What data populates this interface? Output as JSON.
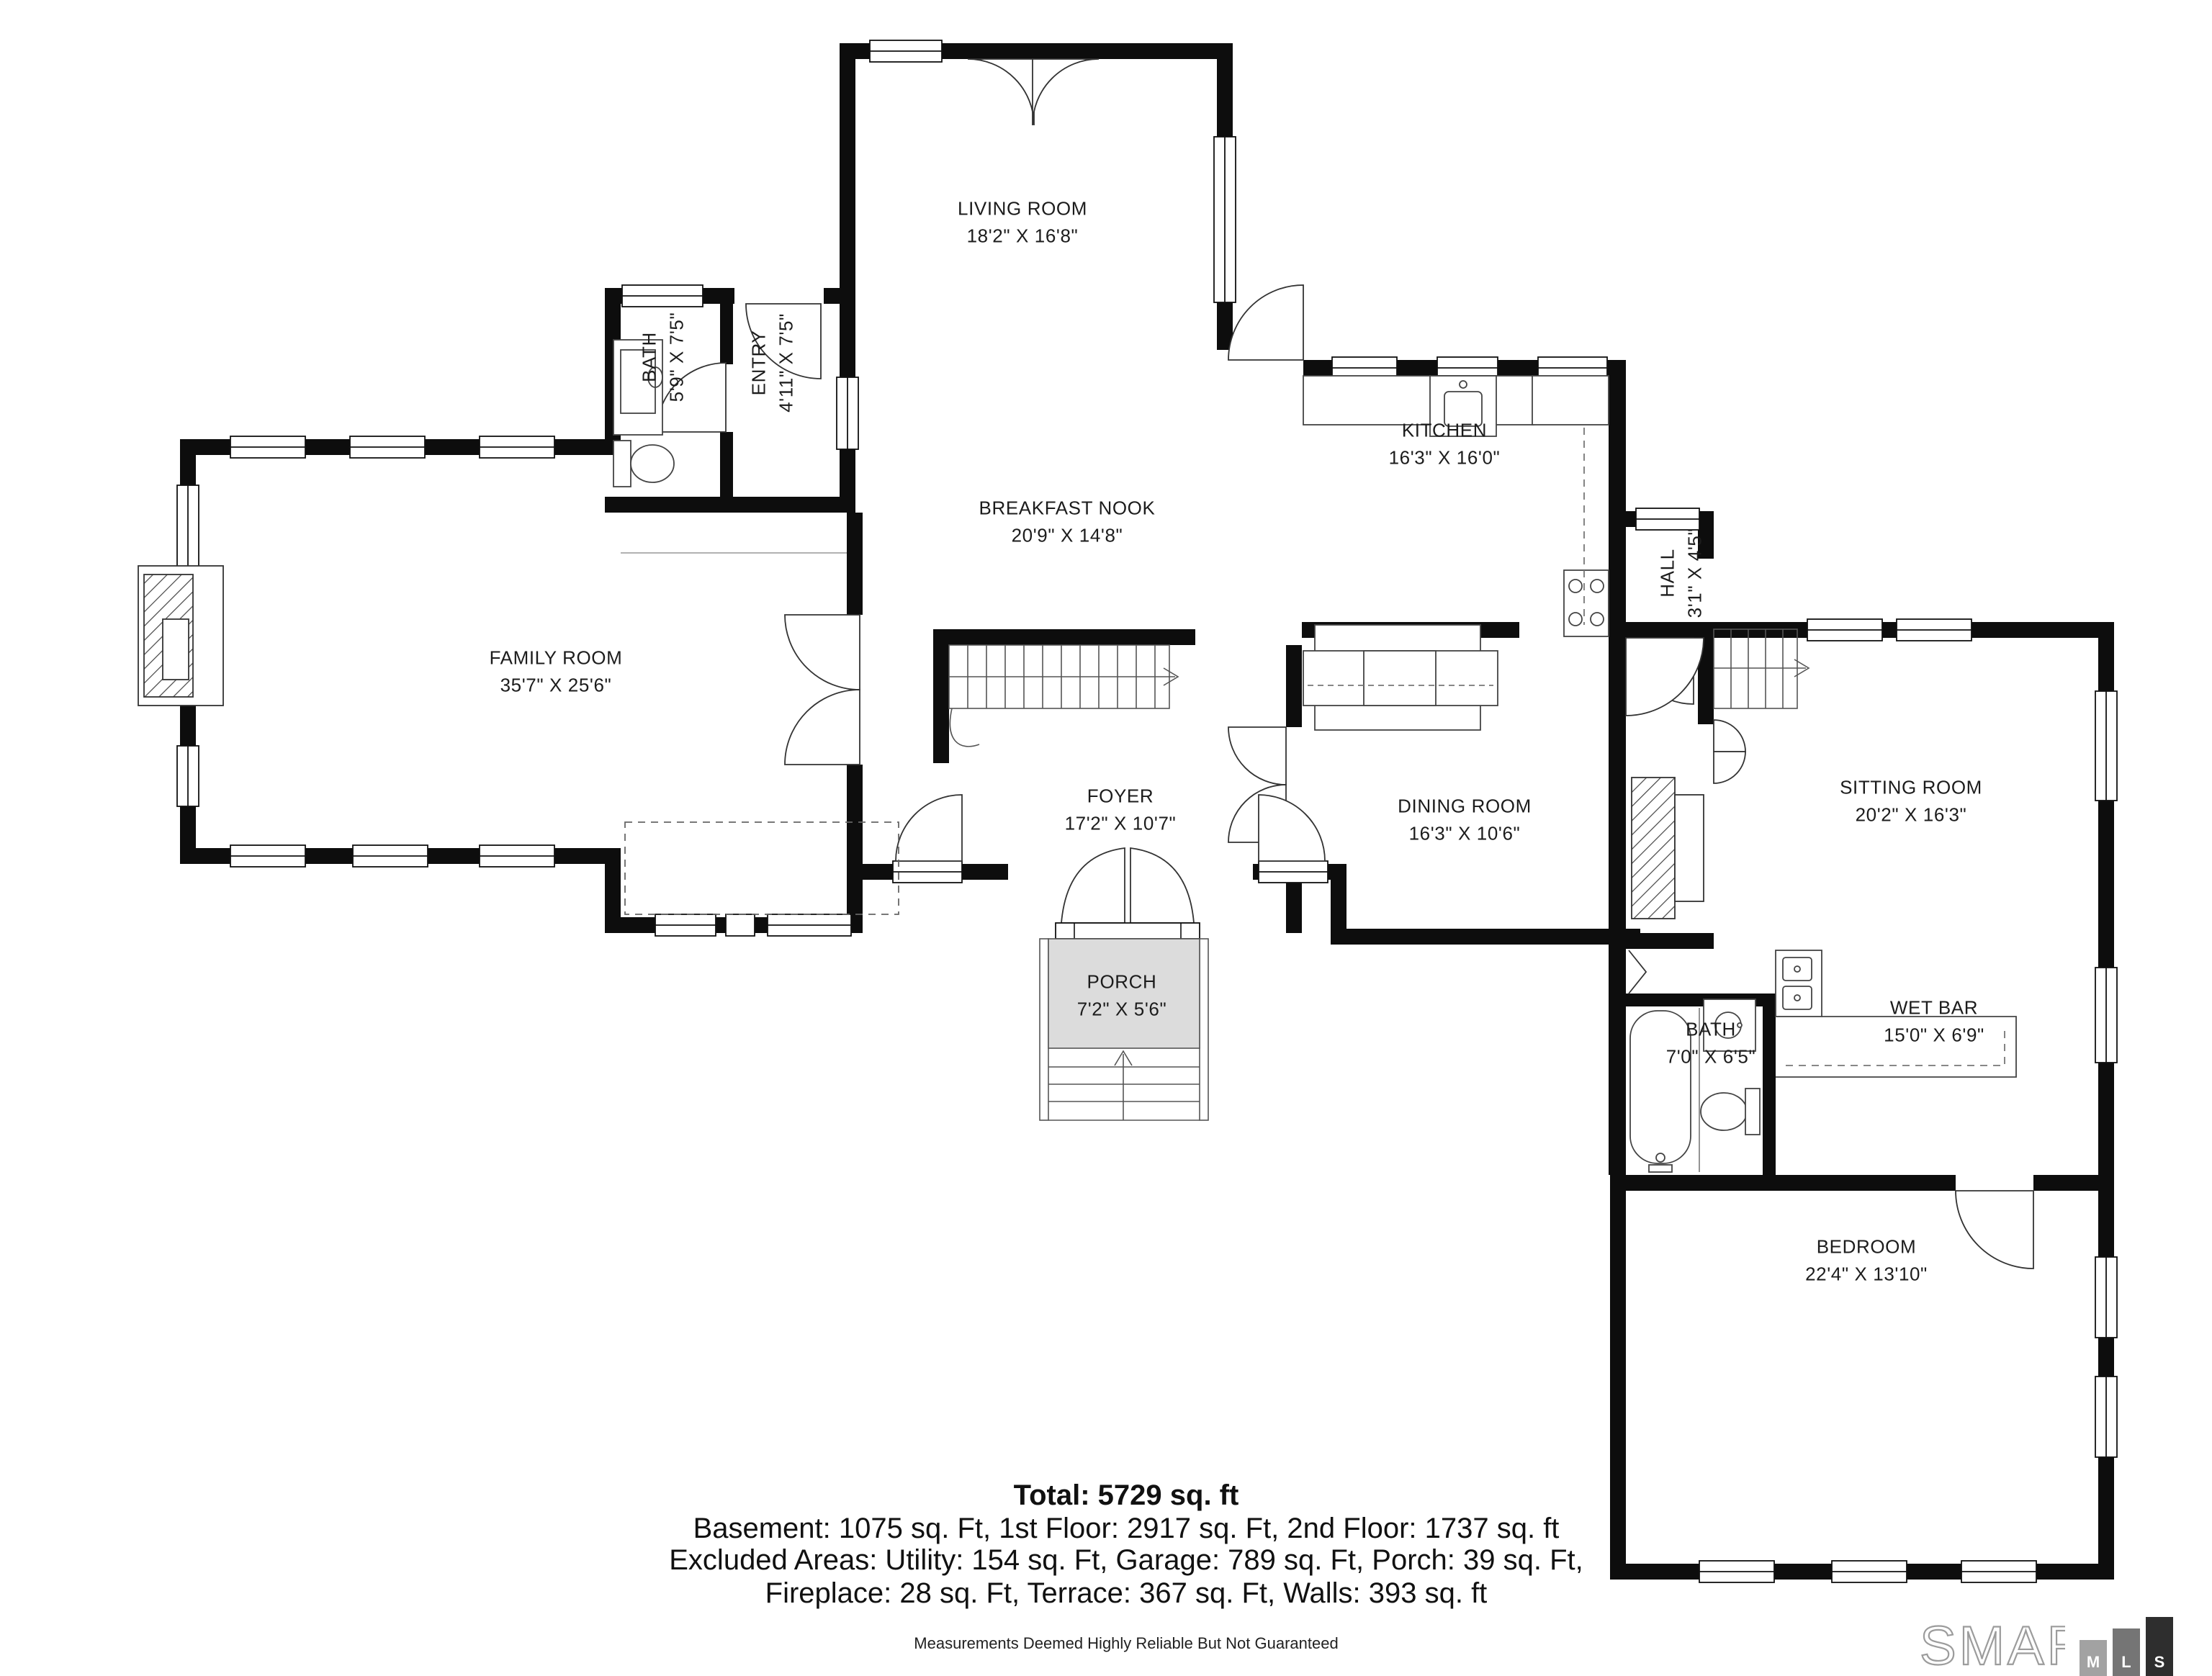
{
  "rooms": [
    {
      "name": "LIVING ROOM",
      "dims": "18'2\" X 16'8\""
    },
    {
      "name": "BATH",
      "dims": "5'9\" X 7'5\""
    },
    {
      "name": "ENTRY",
      "dims": "4'11\" X 7'5\""
    },
    {
      "name": "KITCHEN",
      "dims": "16'3\" X 16'0\""
    },
    {
      "name": "BREAKFAST NOOK",
      "dims": "20'9\" X 14'8\""
    },
    {
      "name": "HALL",
      "dims": "3'1\" X 4'5\""
    },
    {
      "name": "FAMILY ROOM",
      "dims": "35'7\" X 25'6\""
    },
    {
      "name": "FOYER",
      "dims": "17'2\" X 10'7\""
    },
    {
      "name": "DINING ROOM",
      "dims": "16'3\" X 10'6\""
    },
    {
      "name": "SITTING ROOM",
      "dims": "20'2\" X 16'3\""
    },
    {
      "name": "PORCH",
      "dims": "7'2\" X 5'6\""
    },
    {
      "name": "BATH",
      "dims": "7'0\" X 6'5\""
    },
    {
      "name": "WET BAR",
      "dims": "15'0\" X 6'9\""
    },
    {
      "name": "BEDROOM",
      "dims": "22'4\" X 13'10\""
    }
  ],
  "summary": {
    "total": "Total: 5729 sq. ft",
    "line2": "Basement: 1075 sq. Ft, 1st Floor: 2917 sq. Ft, 2nd Floor: 1737 sq. ft",
    "line3": "Excluded Areas: Utility: 154 sq. Ft, Garage: 789 sq. Ft, Porch: 39 sq. Ft,",
    "line4": "Fireplace: 28 sq. Ft, Terrace: 367 sq. Ft, Walls: 393 sq. ft"
  },
  "footer": {
    "disclaimer": "Measurements Deemed Highly Reliable But Not Guaranteed"
  },
  "logo": {
    "word": "SMART",
    "blocks": [
      "M",
      "L",
      "S"
    ],
    "block_colors": [
      "#a2a2a2",
      "#757575",
      "#2e2e2e"
    ],
    "word_outline_color": "#9c9c9c"
  },
  "colors": {
    "walls": "#0d0d0d",
    "porch_fill": "#dcdcdc",
    "background": "#ffffff"
  }
}
